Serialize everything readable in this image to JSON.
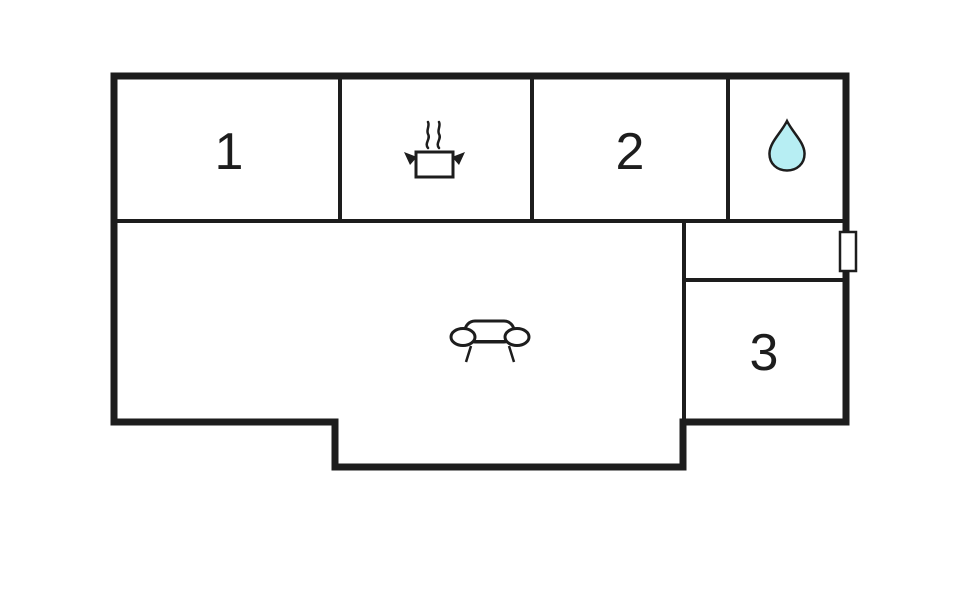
{
  "plan": {
    "background_color": "#ffffff",
    "wall_color": "#1d1d1d",
    "rooms": [
      {
        "name": "room-1",
        "label": "1"
      },
      {
        "name": "kitchen",
        "label": "",
        "icon": "cooking-pot-icon"
      },
      {
        "name": "room-2",
        "label": "2"
      },
      {
        "name": "bathroom",
        "label": "",
        "icon": "water-drop-icon"
      },
      {
        "name": "living-room",
        "label": "",
        "icon": "sofa-icon"
      },
      {
        "name": "hallway",
        "label": ""
      },
      {
        "name": "room-3",
        "label": "3"
      }
    ],
    "icons": {
      "water_drop_fill": "#b7eef3",
      "furniture_fill": "#ffffff"
    },
    "window_marker_fill": "#ffffff"
  }
}
